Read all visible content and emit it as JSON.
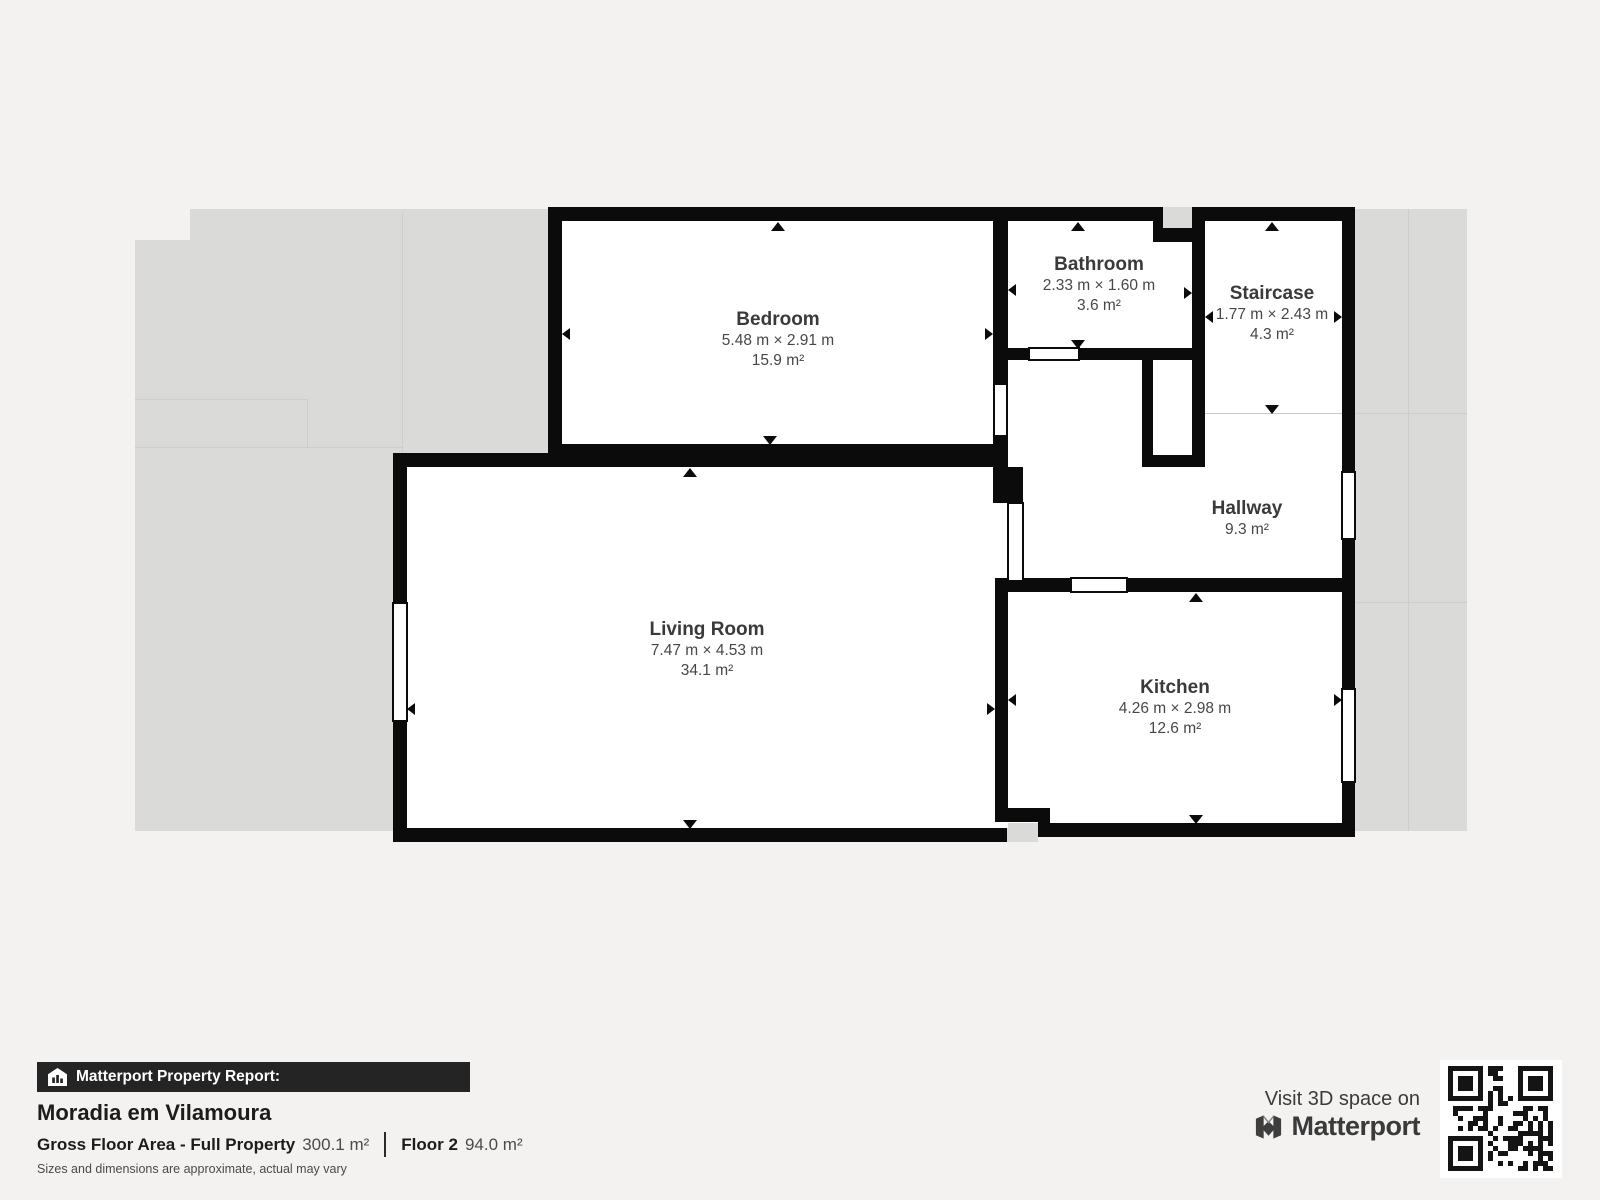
{
  "plan": {
    "rooms": [
      {
        "id": "bedroom",
        "name": "Bedroom",
        "dims": "5.48 m × 2.91 m",
        "area": "15.9 m²"
      },
      {
        "id": "bathroom",
        "name": "Bathroom",
        "dims": "2.33 m × 1.60 m",
        "area": "3.6 m²"
      },
      {
        "id": "staircase",
        "name": "Staircase",
        "dims": "1.77 m × 2.43 m",
        "area": "4.3 m²"
      },
      {
        "id": "hallway",
        "name": "Hallway",
        "area": "9.3 m²"
      },
      {
        "id": "living-room",
        "name": "Living Room",
        "dims": "7.47 m × 4.53 m",
        "area": "34.1 m²"
      },
      {
        "id": "kitchen",
        "name": "Kitchen",
        "dims": "4.26 m × 2.98 m",
        "area": "12.6 m²"
      }
    ]
  },
  "report": {
    "banner": "Matterport Property Report:",
    "title": "Moradia em Vilamoura",
    "gross_label": "Gross Floor Area - Full Property",
    "gross_value": "300.1 m²",
    "floor_label": "Floor 2",
    "floor_value": "94.0 m²",
    "disclaimer": "Sizes and dimensions are approximate, actual may vary"
  },
  "cta": {
    "visit_text": "Visit 3D space on",
    "brand": "Matterport"
  },
  "colors": {
    "wall": "#0b0b0b",
    "backdrop_gray": "#dadad9",
    "page_bg": "#f3f2f0",
    "banner_bg": "#242424",
    "label_text": "#3a3a3a"
  }
}
